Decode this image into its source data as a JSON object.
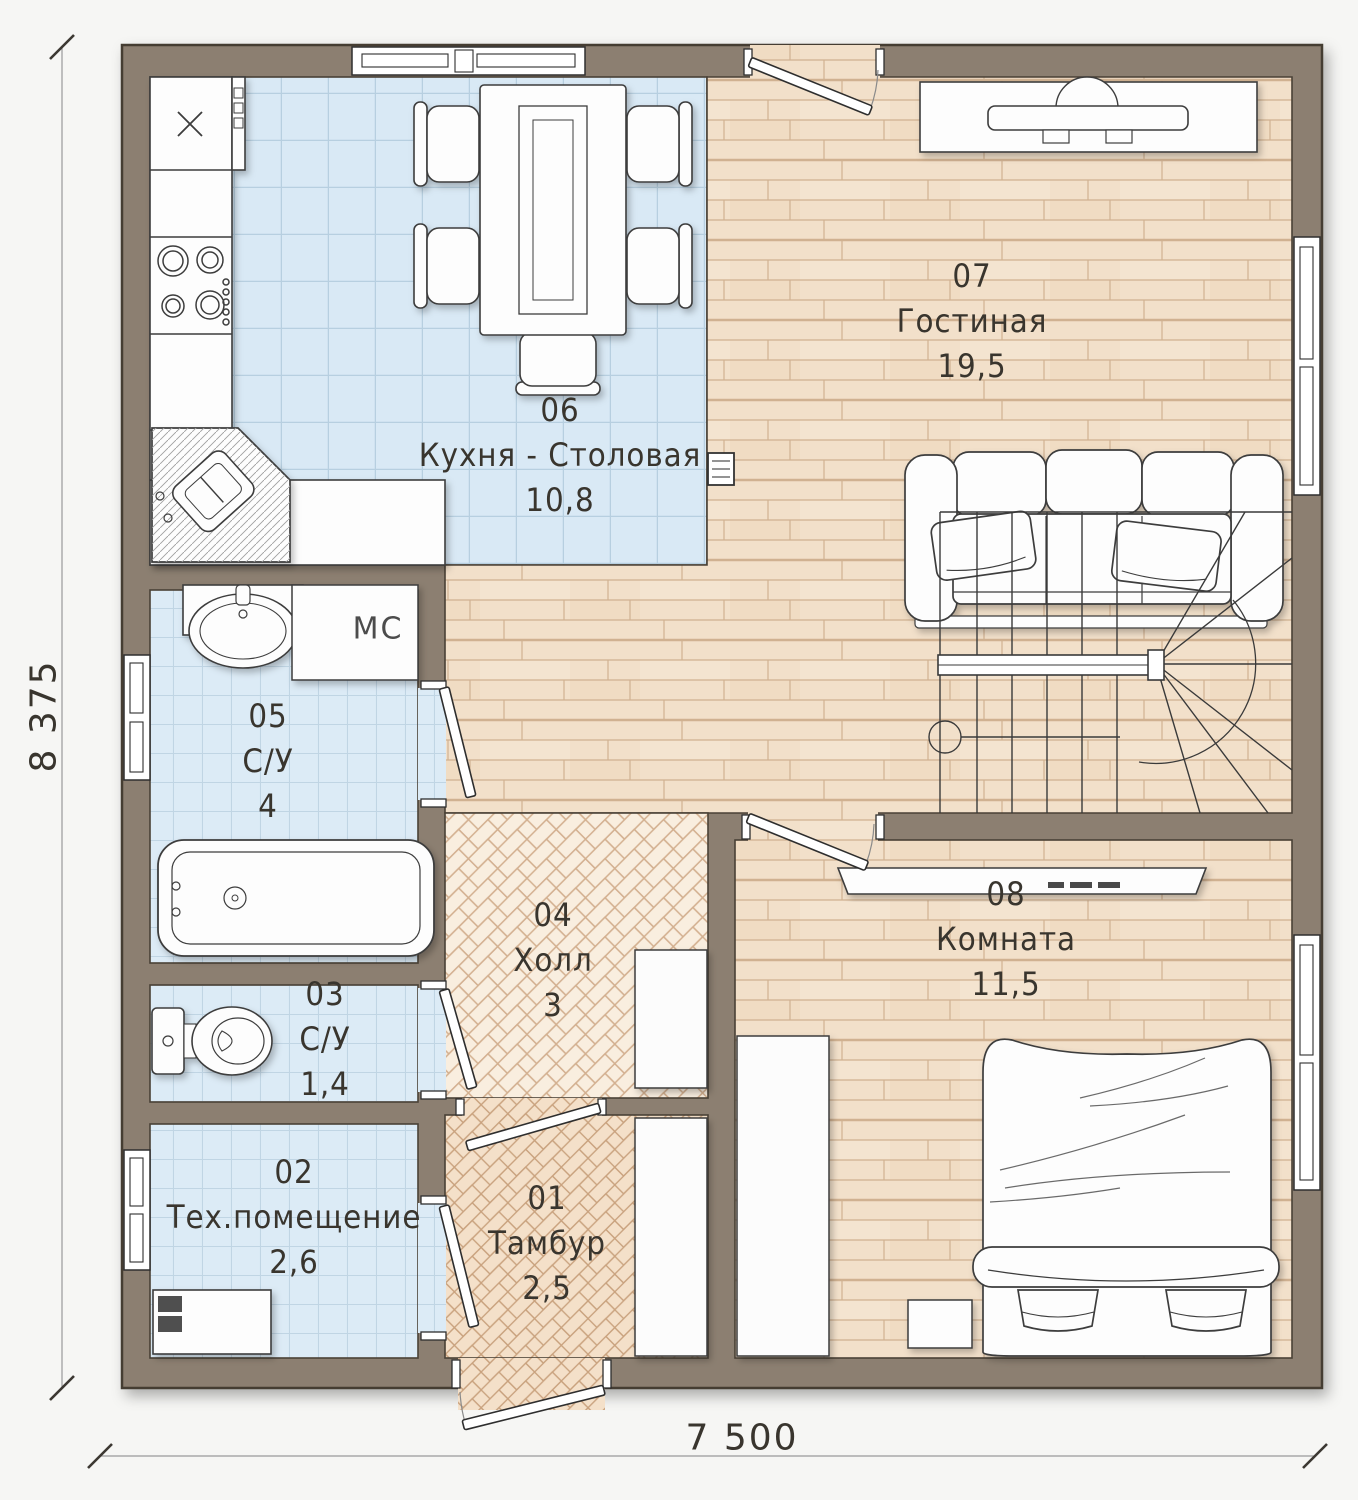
{
  "dimensions": {
    "height": "8 375",
    "width": "7 500"
  },
  "rooms": [
    {
      "number": "01",
      "name": "Тамбур",
      "area": "2,5"
    },
    {
      "number": "02",
      "name": "Тех.помещение",
      "area": "2,6"
    },
    {
      "number": "03",
      "name": "С/У",
      "area": "1,4"
    },
    {
      "number": "04",
      "name": "Холл",
      "area": "3"
    },
    {
      "number": "05",
      "name": "С/У",
      "area": "4"
    },
    {
      "number": "06",
      "name": "Кухня - Столовая",
      "area": "10,8"
    },
    {
      "number": "07",
      "name": "Гостиная",
      "area": "19,5"
    },
    {
      "number": "08",
      "name": "Комната",
      "area": "11,5"
    }
  ],
  "labels": {
    "storage": "МС"
  },
  "colors": {
    "wall": "#8C7F71",
    "tile_kitchen": "#D9E9F5",
    "tile_bath": "#DCEBF6",
    "plank": "#F2E0CA",
    "herringbone_hall": "#F8ECDC",
    "herringbone_tambour": "#F2DCC2",
    "outline": "#3C3C3C"
  }
}
